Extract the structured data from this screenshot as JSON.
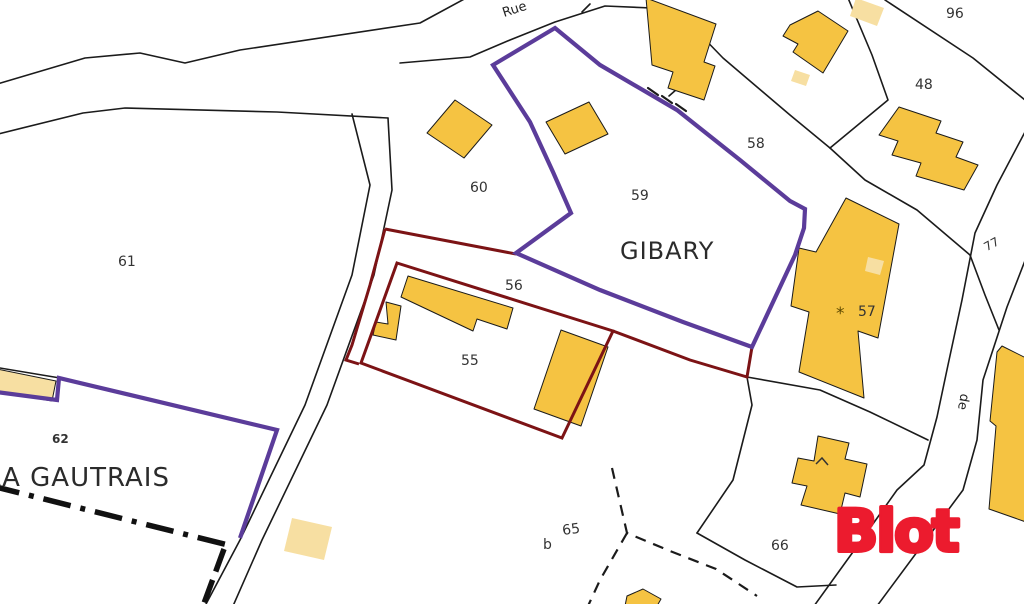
{
  "map": {
    "type": "cadastral-map",
    "background": "#ffffff",
    "colors": {
      "parcel_line": "#1b1b1b",
      "zone_outline_purple": "#5B3C9A",
      "property_outline_red": "#7C1315",
      "building_fill": "#F5C342",
      "building_fill_light": "#F7DFA2",
      "label_text": "#333333"
    },
    "place_names": {
      "gibary": "GIBARY",
      "la_gautrais": "LA GAUTRAIS"
    },
    "road_labels": {
      "rue": "Rue",
      "de": "de"
    },
    "parcels": {
      "p61": "61",
      "p60": "60",
      "p59": "59",
      "p58": "58",
      "p96": "96",
      "p48": "48",
      "p77": "77",
      "p56": "56",
      "p55": "55",
      "p57": "57",
      "p62": "62",
      "p65": "65",
      "p65_sub": "b",
      "p66": "66"
    },
    "annotations": {
      "building_mark": "*"
    }
  },
  "watermark": {
    "logo_text": "Blot",
    "logo_color": "#EC1B2E"
  }
}
